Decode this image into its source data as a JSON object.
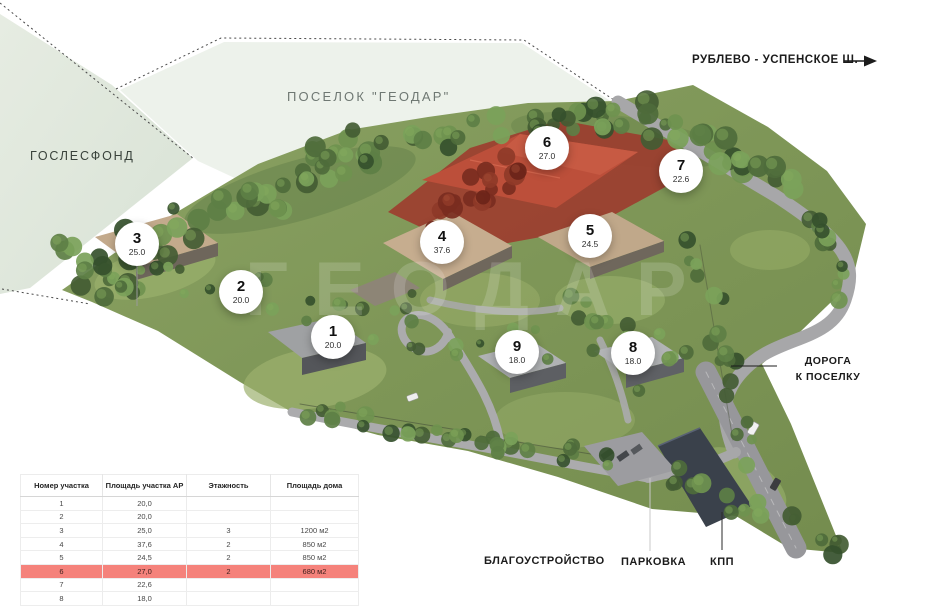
{
  "labels": {
    "settlement": "ПОСЕЛОК \"ГЕОДАР\"",
    "goslesfond": "ГОСЛЕСФОНД",
    "highway": "РУБЛЕВО - УСПЕНСКОЕ Ш.",
    "road_to_settlement": "ДОРОГА К ПОСЕЛКУ",
    "landscaping": "БЛАГОУСТРОЙСТВО",
    "parking": "ПАРКОВКА",
    "checkpoint": "КПП"
  },
  "watermark": "ГЕОДАР",
  "markers": [
    {
      "id": "1",
      "value": "20.0",
      "x": 333,
      "y": 337
    },
    {
      "id": "2",
      "value": "20.0",
      "x": 241,
      "y": 292
    },
    {
      "id": "3",
      "value": "25.0",
      "x": 137,
      "y": 244
    },
    {
      "id": "4",
      "value": "37.6",
      "x": 442,
      "y": 242
    },
    {
      "id": "5",
      "value": "24.5",
      "x": 590,
      "y": 236
    },
    {
      "id": "6",
      "value": "27.0",
      "x": 547,
      "y": 148
    },
    {
      "id": "7",
      "value": "22.6",
      "x": 681,
      "y": 171
    },
    {
      "id": "8",
      "value": "18.0",
      "x": 633,
      "y": 353
    },
    {
      "id": "9",
      "value": "18.0",
      "x": 517,
      "y": 352
    }
  ],
  "table": {
    "headers": [
      "Номер участка",
      "Площадь участка АР",
      "Этажность",
      "Площадь дома"
    ],
    "rows": [
      {
        "plot": "1",
        "area": "20,0",
        "floors": "",
        "house_area": "",
        "highlight": false
      },
      {
        "plot": "2",
        "area": "20,0",
        "floors": "",
        "house_area": "",
        "highlight": false
      },
      {
        "plot": "3",
        "area": "25,0",
        "floors": "3",
        "house_area": "1200 м2",
        "highlight": false
      },
      {
        "plot": "4",
        "area": "37,6",
        "floors": "2",
        "house_area": "850 м2",
        "highlight": false
      },
      {
        "plot": "5",
        "area": "24,5",
        "floors": "2",
        "house_area": "850 м2",
        "highlight": false
      },
      {
        "plot": "6",
        "area": "27,0",
        "floors": "2",
        "house_area": "680 м2",
        "highlight": true
      },
      {
        "plot": "7",
        "area": "22,6",
        "floors": "",
        "house_area": "",
        "highlight": false
      },
      {
        "plot": "8",
        "area": "18,0",
        "floors": "",
        "house_area": "",
        "highlight": false
      },
      {
        "plot": "9",
        "area": "18,0",
        "floors": "",
        "house_area": "",
        "highlight": false
      }
    ]
  },
  "colors": {
    "row_highlight": "#f5827b",
    "highlighted_plot_red": "#b54a38",
    "marker_background": "#ffffff",
    "forest_fund_green": "#e2e9df"
  }
}
